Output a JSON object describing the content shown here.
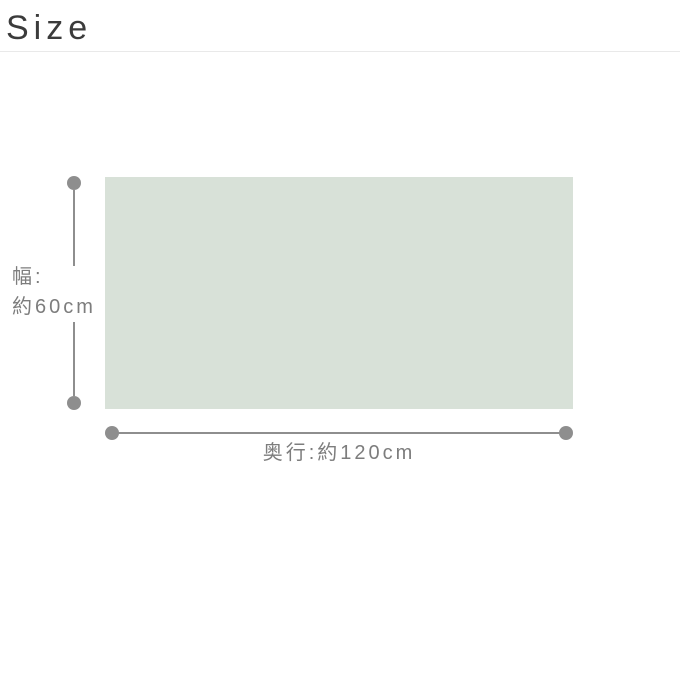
{
  "page": {
    "title": "Size"
  },
  "diagram": {
    "surface": {
      "color": "#d8e1d8"
    },
    "width_dimension": {
      "label_line1": "幅:",
      "label_line2": "約60cm",
      "value_cm": 60
    },
    "depth_dimension": {
      "label": "奥行:約120cm",
      "value_cm": 120
    },
    "colors": {
      "line": "#8e8e8e",
      "label_text": "#7d7d7d",
      "title_text": "#3b3b3b",
      "divider": "#e9e9e9"
    }
  }
}
